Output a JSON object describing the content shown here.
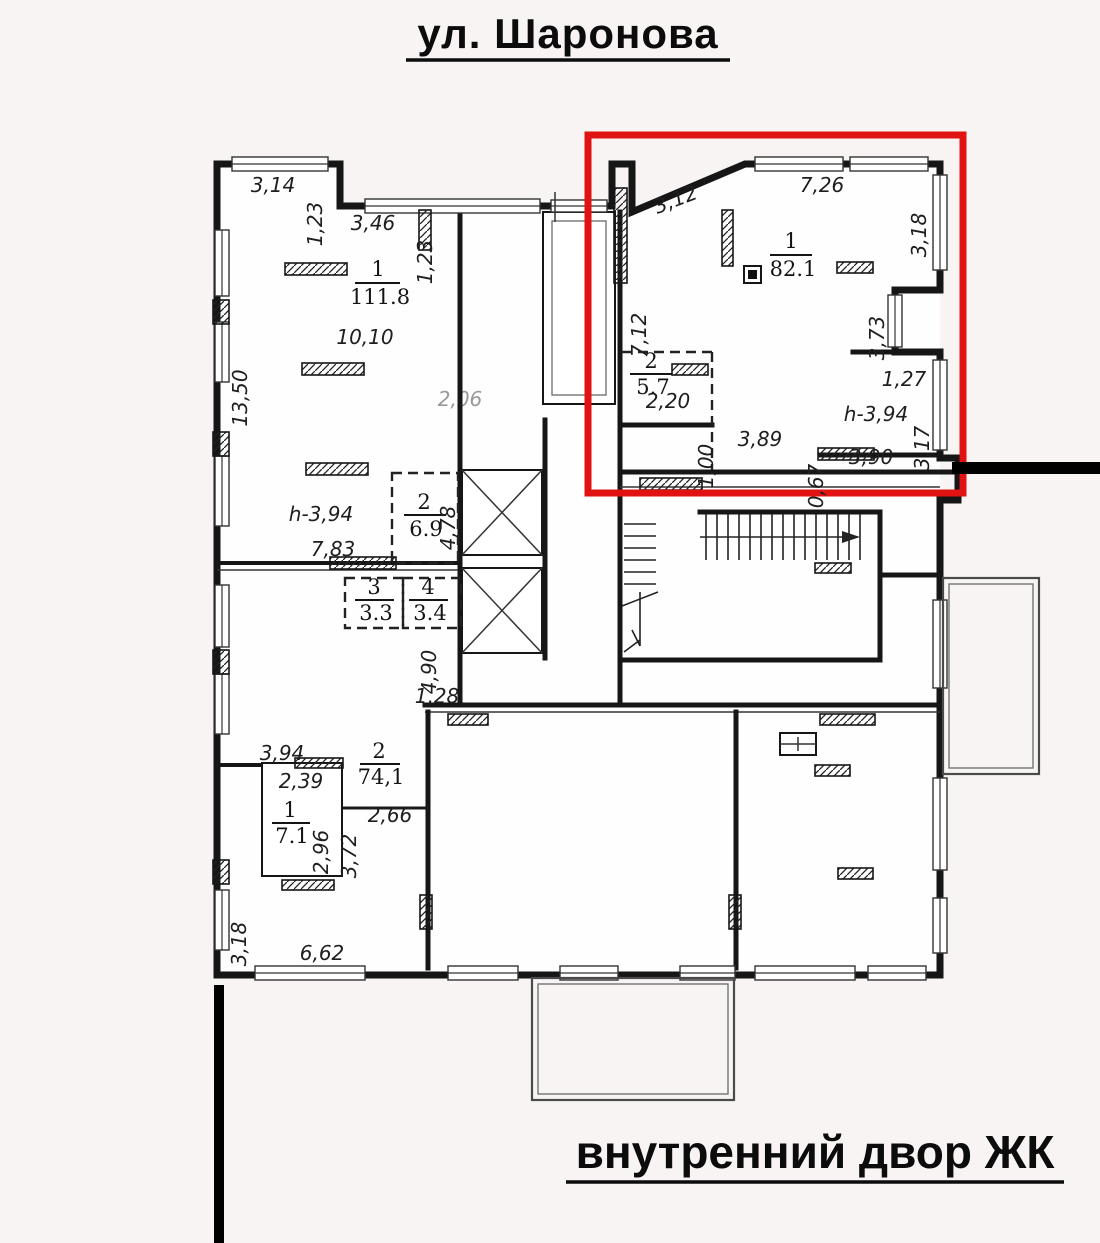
{
  "title": "ул. Шаронова",
  "caption": "внутренний двор ЖК",
  "colors": {
    "highlight_red": "#e01212",
    "wall": "#161616",
    "background": "#f7f4f3",
    "site_line": "#000000"
  },
  "rooms": {
    "r111": {
      "num": "1",
      "area": "111.8"
    },
    "r82": {
      "num": "1",
      "area": "82.1"
    },
    "r57": {
      "num": "2",
      "area": "5.7"
    },
    "r69": {
      "num": "2",
      "area": "6.9"
    },
    "r33": {
      "num": "3",
      "area": "3.3"
    },
    "r34": {
      "num": "4",
      "area": "3.4"
    },
    "r741": {
      "num": "2",
      "area": "74,1"
    },
    "r71": {
      "num": "1",
      "area": "7.1"
    }
  },
  "dims": {
    "t1": "3,14",
    "t2": "1,23",
    "t3": "3,46",
    "t4": "1,23",
    "a_diag": "3,12",
    "a_top": "7,26",
    "a_right": "3,18",
    "a_left": "7,12",
    "a_niche": "3,73",
    "a_220": "2,20",
    "a_127": "1,27",
    "a_h": "h-3,94",
    "a_317": "3,17",
    "a_100": "1,00",
    "a_389": "3,89",
    "a_067": "0,67",
    "a_390": "3,90",
    "l_1350": "13,50",
    "l_1010": "10,10",
    "l_h": "h-3,94",
    "l_783": "7,83",
    "l_478": "4,78",
    "l_490": "4,90",
    "l_206": "2,06",
    "c_128": "1,28",
    "b_394": "3,94",
    "b_239": "2,39",
    "b_296": "2,96",
    "b_372": "3,72",
    "b_266": "2,66",
    "b_318": "3,18",
    "b_662": "6,62"
  }
}
